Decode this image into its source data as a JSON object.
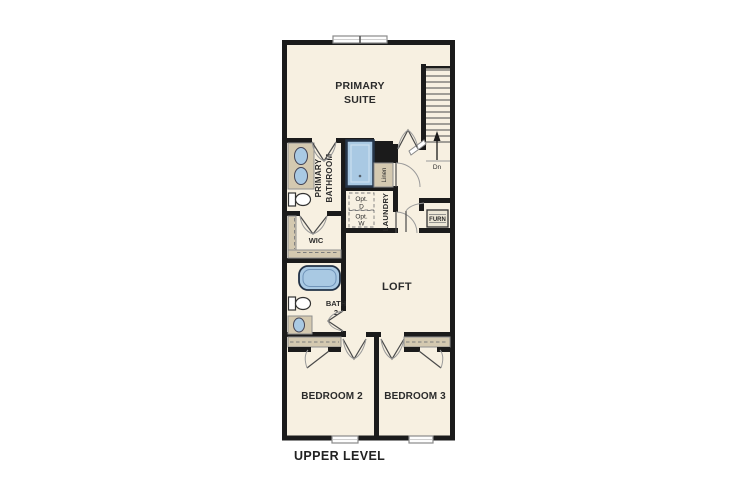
{
  "plan_title": "UPPER LEVEL",
  "rooms": {
    "primary_suite": {
      "line1": "PRIMARY",
      "line2": "SUITE"
    },
    "primary_bathroom": {
      "line1": "PRIMARY",
      "line2": "BATHROOM"
    },
    "wic": {
      "label": "WIC"
    },
    "linen": {
      "label": "Linen"
    },
    "laundry": {
      "label": "LAUNDRY"
    },
    "bath2": {
      "line1": "BATH",
      "line2": "2"
    },
    "loft": {
      "label": "LOFT"
    },
    "bedroom2": {
      "label": "BEDROOM 2"
    },
    "bedroom3": {
      "label": "BEDROOM 3"
    },
    "furnace_closet": {
      "label": "FURN"
    }
  },
  "stairs": {
    "down_label": "Dn"
  },
  "laundry_options": {
    "dryer": {
      "line1": "Opt.",
      "line2": "D"
    },
    "washer": {
      "line1": "Opt.",
      "line2": "W"
    }
  },
  "colors": {
    "background": "#ffffff",
    "floor": "#f7f0e1",
    "wall": "#1b1b1b",
    "fixture_blue": "#a9c9e3",
    "counter_tan": "#d4c9b0"
  }
}
